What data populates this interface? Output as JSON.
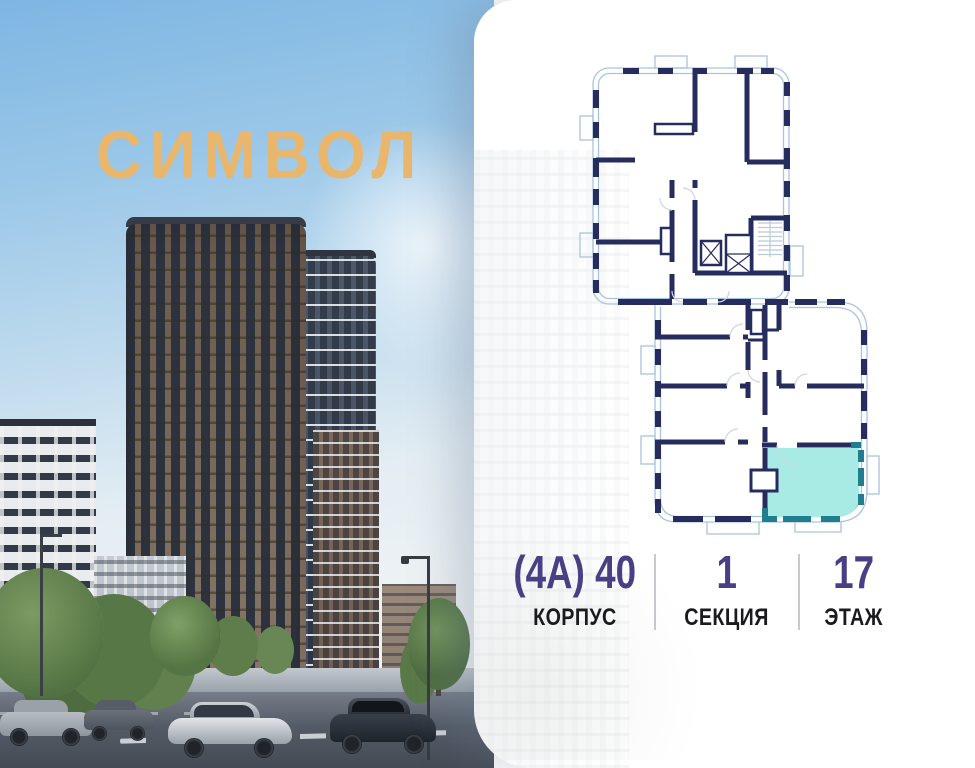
{
  "brand": {
    "logo_text": "СИМВОЛ"
  },
  "panel": {
    "floorplan": {
      "highlighted_unit": {
        "building": "(4А) 40",
        "section": "1",
        "floor": "17"
      }
    },
    "info": {
      "columns": [
        {
          "value": "(4А) 40",
          "label": "КОРПУС"
        },
        {
          "value": "1",
          "label": "СЕКЦИЯ"
        },
        {
          "value": "17",
          "label": "ЭТАЖ"
        }
      ]
    }
  },
  "colors": {
    "gold": "#e8b76d",
    "purple": "#4a3f85",
    "label-ink": "#1b1b1e",
    "divider": "#c7c7cf",
    "navy": "#272c5e",
    "winline": "#a9c4de",
    "lightline": "#ccd6e4",
    "teal": "#217e8e",
    "teal-fill": "#a8ebe4",
    "panel-bg": "#ffffff"
  }
}
